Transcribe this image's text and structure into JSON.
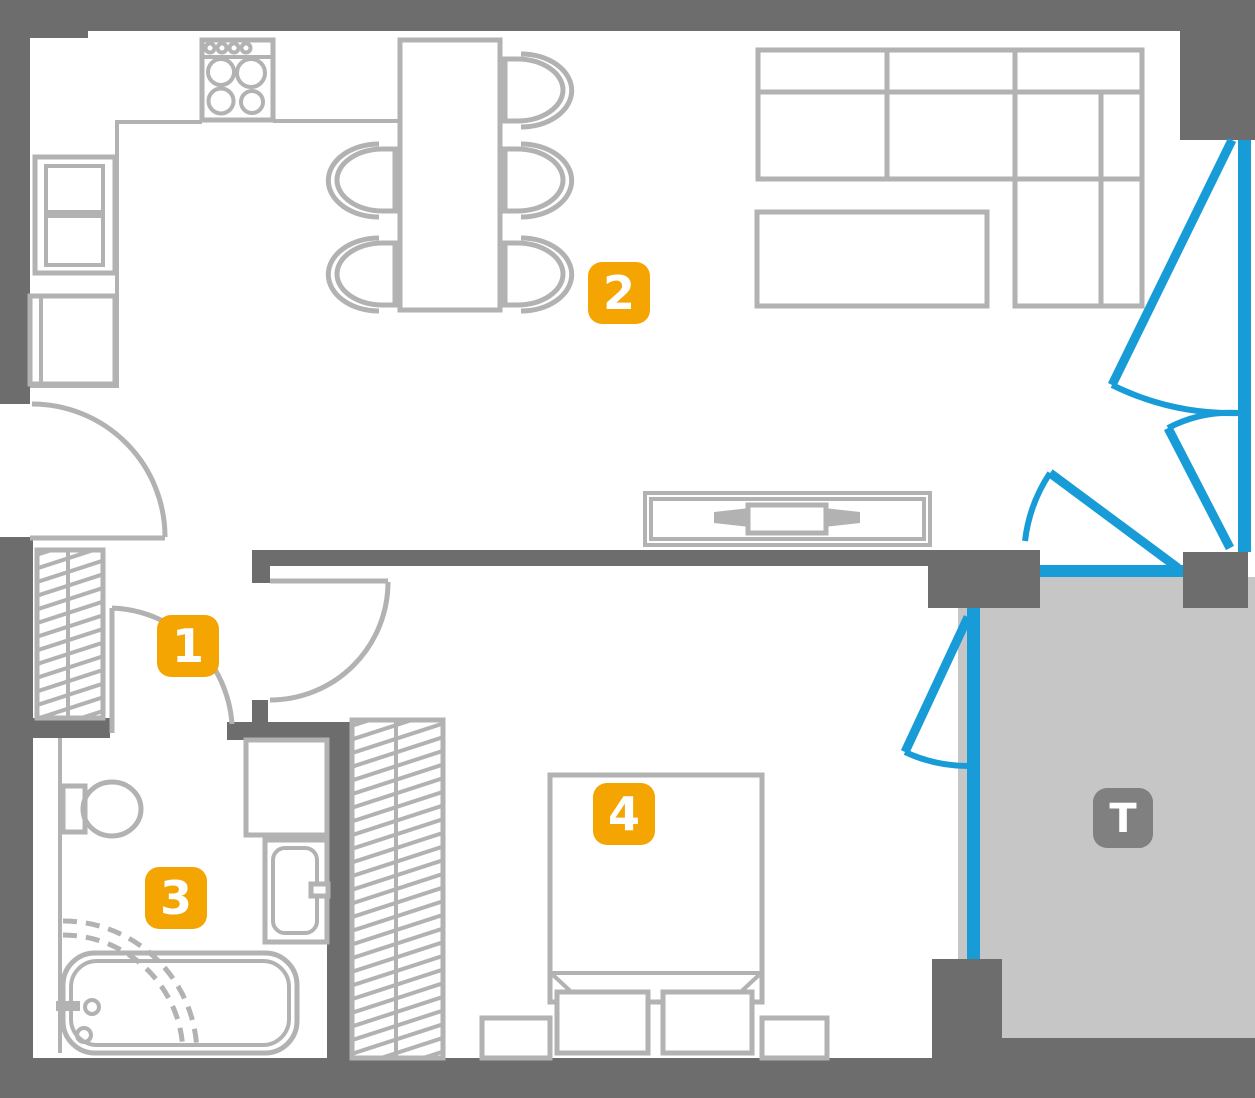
{
  "labels": {
    "room1": "1",
    "room2": "2",
    "room3": "3",
    "room4": "4",
    "terrace": "T"
  },
  "colors": {
    "wall": "#6d6d6d",
    "furniture": "#b2b2b2",
    "window": "#189cd8",
    "label_bg": "#f5a502",
    "label_text": "#ffffff",
    "terrace_floor": "#c6c6c6",
    "terrace_label_bg": "#808080",
    "background": "#ffffff"
  }
}
